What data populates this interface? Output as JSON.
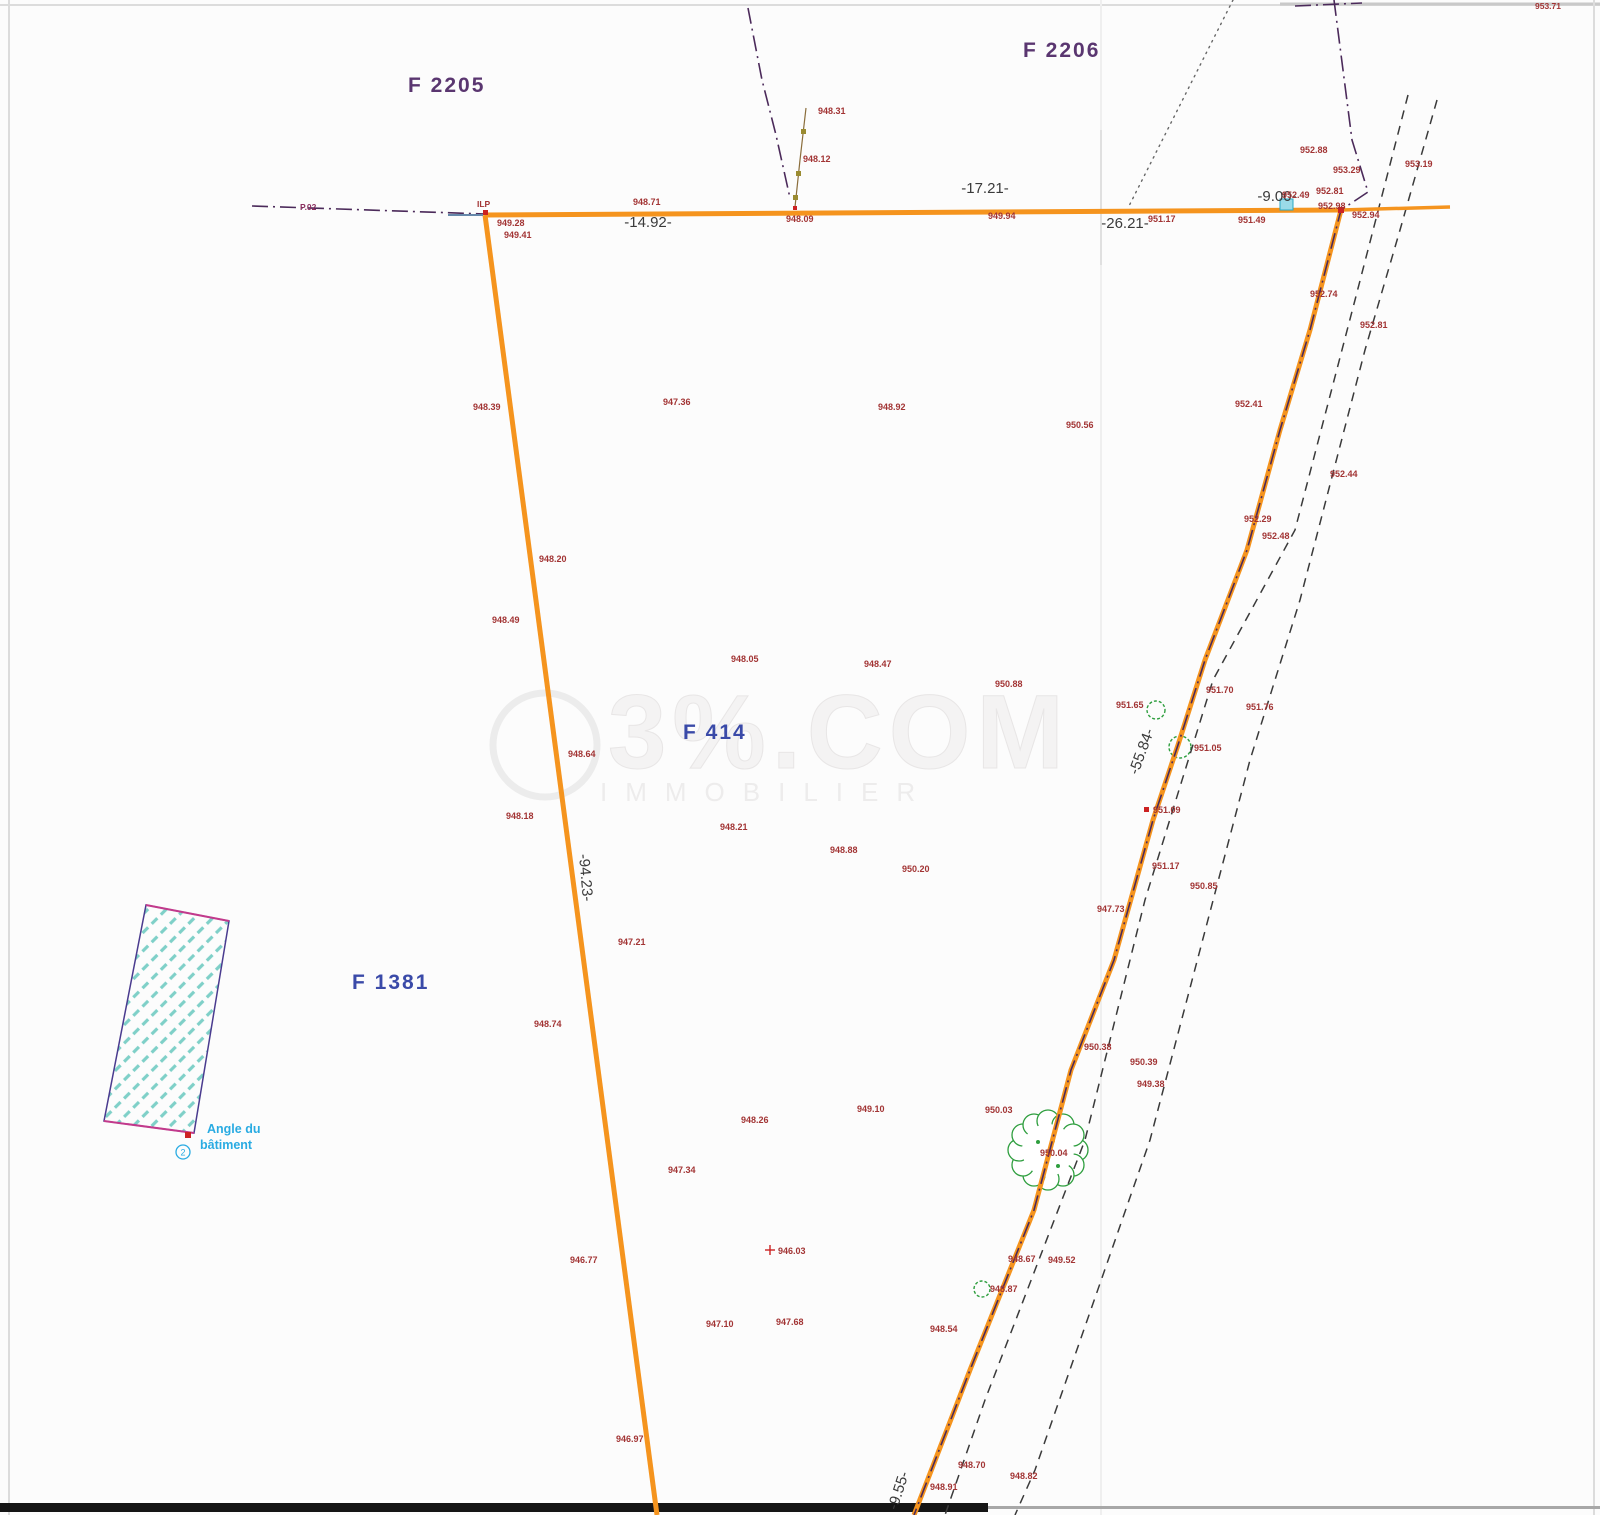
{
  "plan": {
    "parcels": [
      {
        "label": "F 2205",
        "x": 408,
        "y": 92,
        "color_key": "purple"
      },
      {
        "label": "F 2206",
        "x": 1023,
        "y": 57,
        "color_key": "purple"
      },
      {
        "label": "F 414",
        "x": 683,
        "y": 739,
        "color_key": "blue"
      },
      {
        "label": "F 1381",
        "x": 352,
        "y": 989,
        "color_key": "blue"
      }
    ],
    "distance_labels": [
      {
        "text": "-14.92-",
        "x": 648,
        "y": 227,
        "rot": 0
      },
      {
        "text": "-17.21-",
        "x": 985,
        "y": 193,
        "rot": 0
      },
      {
        "text": "-26.21-",
        "x": 1125,
        "y": 228,
        "rot": 0
      },
      {
        "text": "-9.00-",
        "x": 1277,
        "y": 201,
        "rot": 0
      },
      {
        "text": "-94.23-",
        "x": 581,
        "y": 878,
        "rot": 85
      },
      {
        "text": "-55.84-",
        "x": 1146,
        "y": 753,
        "rot": -70
      },
      {
        "text": "-9.55-",
        "x": 903,
        "y": 1492,
        "rot": -72
      }
    ],
    "spot_elevations": [
      {
        "x": 497,
        "y": 226,
        "v": "949.28"
      },
      {
        "x": 504,
        "y": 238,
        "v": "949.41"
      },
      {
        "x": 633,
        "y": 205,
        "v": "948.71"
      },
      {
        "x": 786,
        "y": 222,
        "v": "948.09"
      },
      {
        "x": 818,
        "y": 114,
        "v": "948.31"
      },
      {
        "x": 803,
        "y": 162,
        "v": "948.12"
      },
      {
        "x": 988,
        "y": 219,
        "v": "949.94"
      },
      {
        "x": 1148,
        "y": 222,
        "v": "951.17"
      },
      {
        "x": 1238,
        "y": 223,
        "v": "951.49"
      },
      {
        "x": 1282,
        "y": 198,
        "v": "952.49"
      },
      {
        "x": 1316,
        "y": 194,
        "v": "952.81"
      },
      {
        "x": 1318,
        "y": 209,
        "v": "952.98"
      },
      {
        "x": 1352,
        "y": 218,
        "v": "952.94"
      },
      {
        "x": 1300,
        "y": 153,
        "v": "952.88"
      },
      {
        "x": 1333,
        "y": 173,
        "v": "953.29"
      },
      {
        "x": 1405,
        "y": 167,
        "v": "953.19"
      },
      {
        "x": 1310,
        "y": 297,
        "v": "952.74"
      },
      {
        "x": 1360,
        "y": 328,
        "v": "952.81"
      },
      {
        "x": 1235,
        "y": 407,
        "v": "952.41"
      },
      {
        "x": 1066,
        "y": 428,
        "v": "950.56"
      },
      {
        "x": 1330,
        "y": 477,
        "v": "952.44"
      },
      {
        "x": 1244,
        "y": 522,
        "v": "952.29"
      },
      {
        "x": 1262,
        "y": 539,
        "v": "952.48"
      },
      {
        "x": 473,
        "y": 410,
        "v": "948.39"
      },
      {
        "x": 663,
        "y": 405,
        "v": "947.36"
      },
      {
        "x": 878,
        "y": 410,
        "v": "948.92"
      },
      {
        "x": 539,
        "y": 562,
        "v": "948.20"
      },
      {
        "x": 492,
        "y": 623,
        "v": "948.49"
      },
      {
        "x": 731,
        "y": 662,
        "v": "948.05"
      },
      {
        "x": 864,
        "y": 667,
        "v": "948.47"
      },
      {
        "x": 995,
        "y": 687,
        "v": "950.88"
      },
      {
        "x": 1116,
        "y": 708,
        "v": "951.65"
      },
      {
        "x": 1206,
        "y": 693,
        "v": "951.70"
      },
      {
        "x": 1246,
        "y": 710,
        "v": "951.76"
      },
      {
        "x": 1194,
        "y": 751,
        "v": "951.05"
      },
      {
        "x": 568,
        "y": 757,
        "v": "948.64"
      },
      {
        "x": 506,
        "y": 819,
        "v": "948.18"
      },
      {
        "x": 720,
        "y": 830,
        "v": "948.21"
      },
      {
        "x": 830,
        "y": 853,
        "v": "948.88"
      },
      {
        "x": 902,
        "y": 872,
        "v": "950.20"
      },
      {
        "x": 1152,
        "y": 869,
        "v": "951.17"
      },
      {
        "x": 1190,
        "y": 889,
        "v": "950.85"
      },
      {
        "x": 1097,
        "y": 912,
        "v": "947.73"
      },
      {
        "x": 1153,
        "y": 813,
        "v": "951.09"
      },
      {
        "x": 618,
        "y": 945,
        "v": "947.21"
      },
      {
        "x": 534,
        "y": 1027,
        "v": "948.74"
      },
      {
        "x": 857,
        "y": 1112,
        "v": "949.10"
      },
      {
        "x": 985,
        "y": 1113,
        "v": "950.03"
      },
      {
        "x": 741,
        "y": 1123,
        "v": "948.26"
      },
      {
        "x": 668,
        "y": 1173,
        "v": "947.34"
      },
      {
        "x": 1084,
        "y": 1050,
        "v": "950.38"
      },
      {
        "x": 1130,
        "y": 1065,
        "v": "950.39"
      },
      {
        "x": 1137,
        "y": 1087,
        "v": "949.38"
      },
      {
        "x": 1040,
        "y": 1156,
        "v": "950.04"
      },
      {
        "x": 570,
        "y": 1263,
        "v": "946.77"
      },
      {
        "x": 778,
        "y": 1254,
        "v": "946.03"
      },
      {
        "x": 930,
        "y": 1332,
        "v": "948.54"
      },
      {
        "x": 706,
        "y": 1327,
        "v": "947.10"
      },
      {
        "x": 776,
        "y": 1325,
        "v": "947.68"
      },
      {
        "x": 616,
        "y": 1442,
        "v": "946.97"
      },
      {
        "x": 958,
        "y": 1468,
        "v": "948.70"
      },
      {
        "x": 1010,
        "y": 1479,
        "v": "948.82"
      },
      {
        "x": 930,
        "y": 1490,
        "v": "948.91"
      },
      {
        "x": 990,
        "y": 1292,
        "v": "948.87"
      },
      {
        "x": 1008,
        "y": 1262,
        "v": "948.67"
      },
      {
        "x": 1048,
        "y": 1263,
        "v": "949.52"
      }
    ],
    "misc_labels": [
      {
        "text": "P.02",
        "x": 300,
        "y": 210,
        "color": "#8b2f5e"
      },
      {
        "text": "ILP",
        "x": 477,
        "y": 207,
        "color": "#a23434"
      },
      {
        "text": "953.71",
        "x": 1535,
        "y": 9,
        "color": "#a23434"
      }
    ],
    "building_note": {
      "line1": "Angle du",
      "line2": "bâtiment",
      "symbol": "2"
    },
    "watermark": {
      "main": "3%.COM",
      "sub": "IMMOBILIER"
    },
    "colors": {
      "boundary": "#f5941e",
      "spot_value": "#a23434",
      "distance": "#3a3a3a",
      "parcel_purple": "#5a3670",
      "parcel_blue": "#3a4aa8",
      "cyan": "#29abe2",
      "green": "#2e9e3e",
      "hatch": "#7fd0c8",
      "building_border": "#4a3b8f",
      "building_edge": "#c23a8c",
      "dashdot": "#4b2a5a"
    }
  }
}
